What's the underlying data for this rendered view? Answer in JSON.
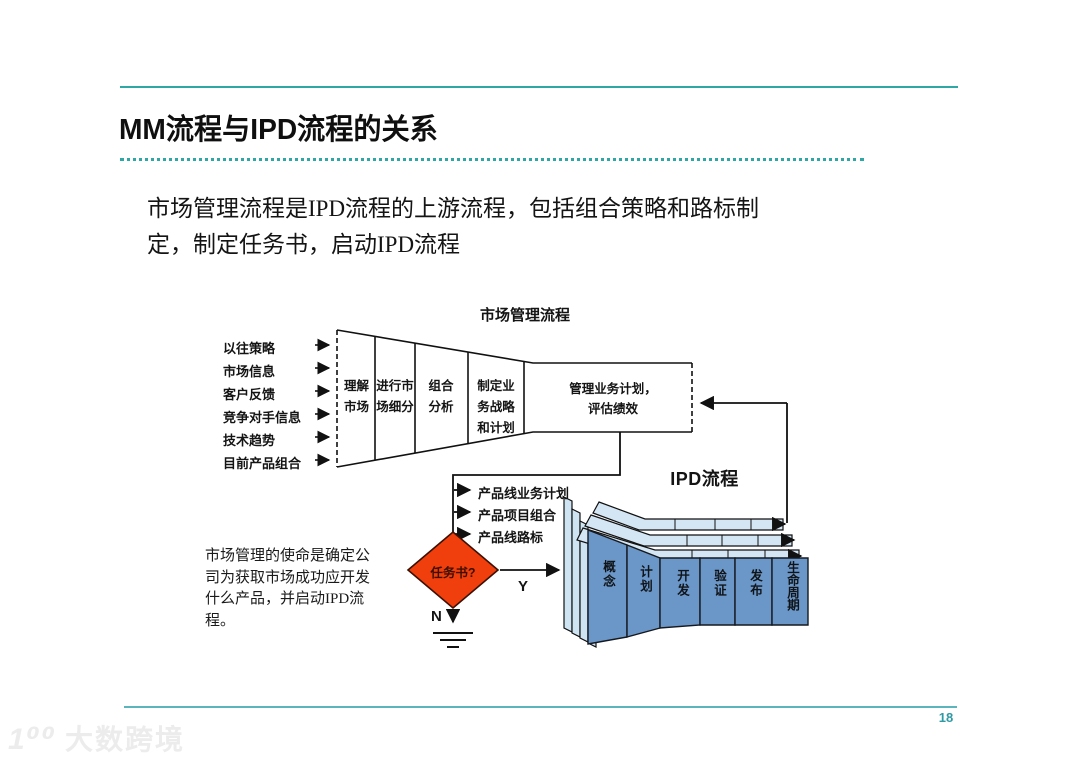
{
  "slide": {
    "title": "MM流程与IPD流程的关系",
    "body": "市场管理流程是IPD流程的上游流程，包括组合策略和路标制\n定，制定任务书，启动IPD流程",
    "caption": "市场管理的使命是确定公司为获取市场成功应开发什么产品，并启动IPD流程。",
    "page_number": "18",
    "watermark_logo": "1⁰⁰",
    "watermark_text": "大数跨境"
  },
  "diagram": {
    "title": "市场管理流程",
    "inputs": [
      "以往策略",
      "市场信息",
      "客户反馈",
      "竞争对手信息",
      "技术趋势",
      "目前产品组合"
    ],
    "funnel_stages": [
      "理解市场",
      "进行市场细分",
      "组合分析",
      "制定业务战略和计划"
    ],
    "manage_box": "管理业务计划，\n评估绩效",
    "outputs": [
      "产品线业务计划",
      "产品项目组合",
      "产品线路标"
    ],
    "decision_label": "任务书?",
    "yes_label": "Y",
    "no_label": "N",
    "ipd_title": "IPD流程",
    "ipd_phases": [
      "概念",
      "计划",
      "开发",
      "验证",
      "发布",
      "生命周期"
    ],
    "colors": {
      "accent_teal": "#2fa8a5",
      "decision_red": "#f03e0c",
      "phase_blue": "#6b97c8",
      "layer_blue": "#cfe4f2"
    }
  }
}
